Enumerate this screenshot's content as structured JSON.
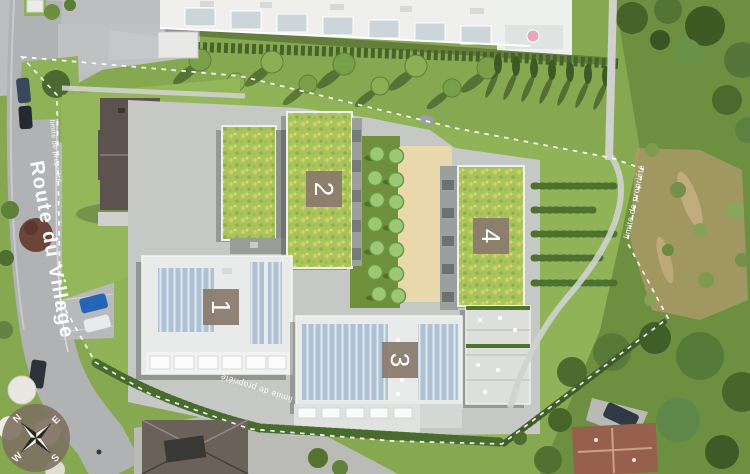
{
  "plan": {
    "road_name": "Route du Village",
    "boundary_label": "limite de propriété",
    "buildings": [
      {
        "number": "1"
      },
      {
        "number": "2"
      },
      {
        "number": "3"
      },
      {
        "number": "4"
      }
    ],
    "compass": {
      "north": "N",
      "east": "E",
      "south": "S",
      "west": "W"
    },
    "colors": {
      "building_label_bg": "#8a7a6d",
      "building_label_text": "#ffffff",
      "boundary_line": "#ffffff",
      "meadow_roof": "#a9c45c",
      "sand_courtyard": "#e7d7ac",
      "road": "#b2b3b5",
      "grass": "#86a851"
    }
  }
}
